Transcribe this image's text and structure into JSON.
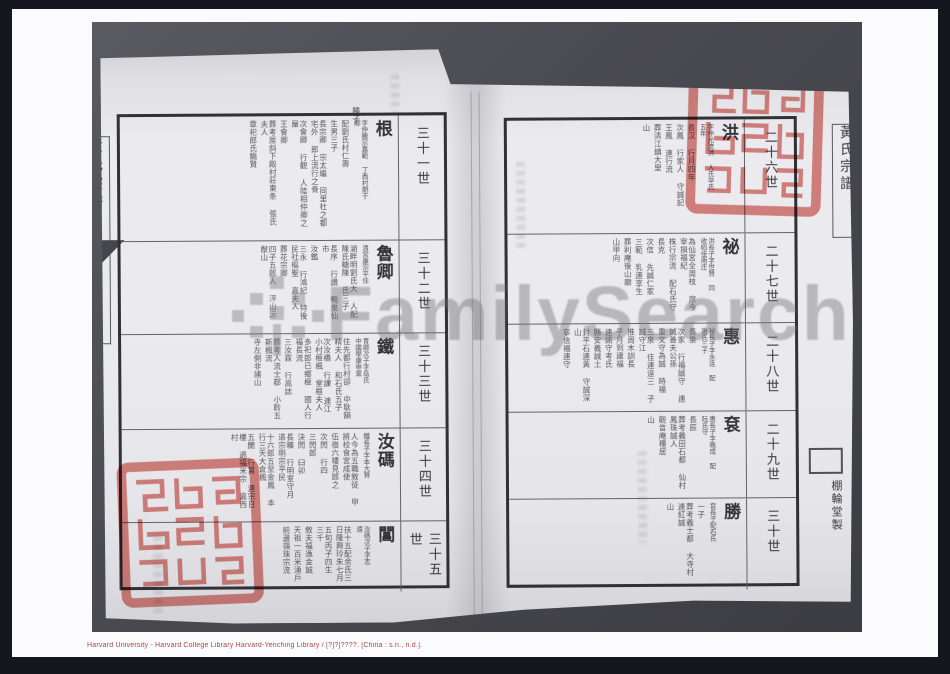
{
  "caption": "Harvard University - Harvard College Library Harvard-Yenching Library / [?]?]????. [China : s.n., n.d.].",
  "watermark": {
    "text": "FamilySearch"
  },
  "book": {
    "left_page": {
      "spine_title": "黃氏宗譜",
      "top_note": "勝子",
      "rows": [
        {
          "generation": "三十一世",
          "head": "根",
          "note": "字仲騰宗嘉範 丁酉村期于卿",
          "columns": [
            "配劉氏村仁壽",
            "生男三子",
            "長宗卿 宗太繼 同里杜之都宅外 郎上流行之骨",
            "次會卿 行觀 人陸相仲卿之屋",
            "王會卿",
            "葬考厔斜下殿村莊東条 張氏夫人",
            "章祀郎氏觴賢"
          ]
        },
        {
          "generation": "三十二世",
          "head": "魯卿",
          "note": "清宮康宗平住",
          "columns": [
            "湖畔明劉氏大 人配陳氏糖陳 氏三子",
            "長序 行讚 鴨泉仙市",
            "汝鑑",
            "三永 行鴻記 特後民社樞聖 嘉夫人",
            "葬花宗卿",
            "四子五郎人 泙山沶猷山"
          ]
        },
        {
          "generation": "三十三世",
          "head": "鐵",
          "note": "青卿次子字岳氏 中國學康申黨",
          "columns": [
            "住先都行村卻 中耿韻精夫人 和石氏五子",
            "次汝橋 行課 連江小村榧楓 堂榧夫人",
            "多祀郎已鄉榧 國人行福長流",
            "三汝霖 行高誌",
            "葬考人流士鄀 小聆五斯楓流",
            "寺左側非諸山"
          ]
        },
        {
          "generation": "三十四世",
          "head": "汝碼",
          "note": "鐵長子字本大賢",
          "columns": [
            "人今為五職敘徒 甲將校食宮成使",
            "伍宿六樓見郎之",
            "次閌 行四",
            "三閌郎",
            "決閌 臼卯",
            "長曠 行明室守月 道宗明宗平民",
            "十六郎五至金鳳 本行三天大倉楓",
            "五閬 行貫 連宗日樓 遶福米宗 嘉西村"
          ]
        },
        {
          "generation": "三十五世",
          "head": "閶",
          "note": "汝碼次子字志遠",
          "columns": [
            "扶十五配余氏三 日隆興玲朱七月",
            "五旬丙子四生 三千",
            "敘夫福逸金誠",
            "天祖一百米湧戶",
            "前邊嶺珠宗流"
          ]
        }
      ]
    },
    "right_page": {
      "spine_title": "黃氏宗譜",
      "colophon": "棚輪堂製",
      "rows": [
        {
          "generation": "二十六世",
          "head": "洪",
          "note": "字仲光流洪 人氏卒氏五年",
          "columns": [
            "長汉 行月四年",
            "次鳳 行家人 守誠記",
            "王鳳 連行流",
            "葬清江鎮大里",
            "山"
          ]
        },
        {
          "generation": "二十七世",
          "head": "祕",
          "note": "洪長子字世賢 同收昭佳南庄",
          "columns": [
            "為仙宮全周枝 庶今宰損福紀",
            "株行宗流 配石氏守",
            "長克",
            "次信 先誠仁家",
            "三範 乳連享生",
            "葬利庵後山廟",
            "山甲向"
          ]
        },
        {
          "generation": "二十八世",
          "head": "惠",
          "note": "祕長子字水连 配謝氏三子",
          "columns": [
            "長泉",
            "次家 行福誠守 連誠善夫公孫",
            "重文守為誠 時福",
            "三泉 佳連遠三 子誠守江",
            "推周木訓長",
            "子月到建福",
            "連諾守考氏",
            "縣安義誠土",
            "封平石連黃 守誠深山",
            "寧信福連守"
          ]
        },
        {
          "generation": "二十九世",
          "head": "袞",
          "note": "惠長子字晚成 配阮氏守",
          "columns": [
            "長辰",
            "葬考義田石都 仙村鳳珠誠人",
            "觀音庵種居",
            "山"
          ]
        },
        {
          "generation": "三十世",
          "head": "勝",
          "note": "袞長子配石氏",
          "columns": [
            "一子",
            "葬考義士都 大寺村連紅誠",
            "山"
          ]
        }
      ]
    }
  }
}
